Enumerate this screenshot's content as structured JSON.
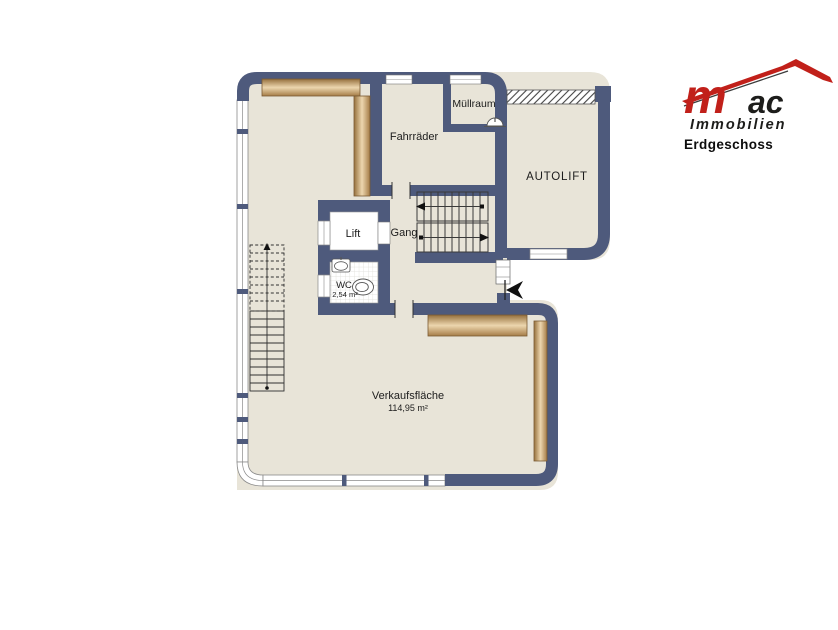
{
  "branding": {
    "logo": {
      "m": "m",
      "ac": "ac",
      "subtitle": "Immobilien",
      "red": "#c1201a",
      "dark": "#1d1d1b"
    },
    "floor_label": "Erdgeschoss"
  },
  "plan": {
    "colors": {
      "wall": "#4e5a7c",
      "floor": "#e8e4d8",
      "wood_light": "#ecd6ae",
      "wood_dark": "#96703d",
      "wood_edge": "#7a5a33",
      "glazing_line": "#8a8a8a",
      "drawing_line": "#333333"
    },
    "rooms": {
      "muellraum": {
        "label": "Müllraum"
      },
      "fahrraeder": {
        "label": "Fahrräder"
      },
      "autolift": {
        "label": "AUTOLIFT"
      },
      "lift": {
        "label": "Lift"
      },
      "gang": {
        "label": "Gang"
      },
      "wc": {
        "label": "WC",
        "area": "2,54 m²"
      },
      "verkaufsflaeche": {
        "label": "Verkaufsfläche",
        "area": "114,95 m²"
      }
    }
  }
}
